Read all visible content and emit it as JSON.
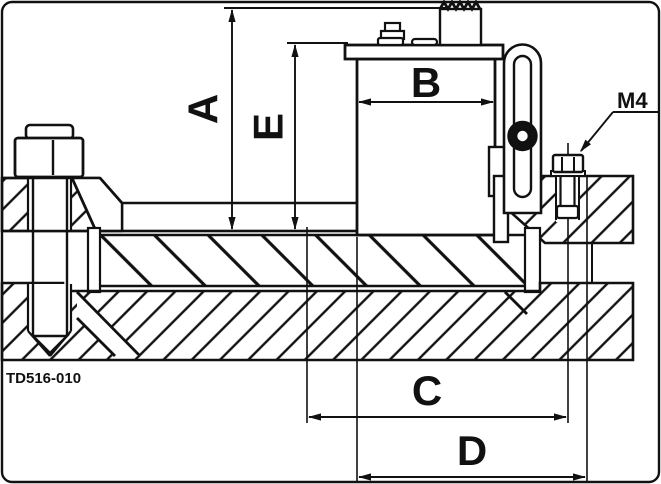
{
  "drawing": {
    "part_number": "TD516-010",
    "labels": {
      "dim_a": "A",
      "dim_b": "B",
      "dim_c": "C",
      "dim_d": "D",
      "dim_e": "E",
      "thread": "M4"
    },
    "line_color": "#111111",
    "background": "#ffffff"
  }
}
